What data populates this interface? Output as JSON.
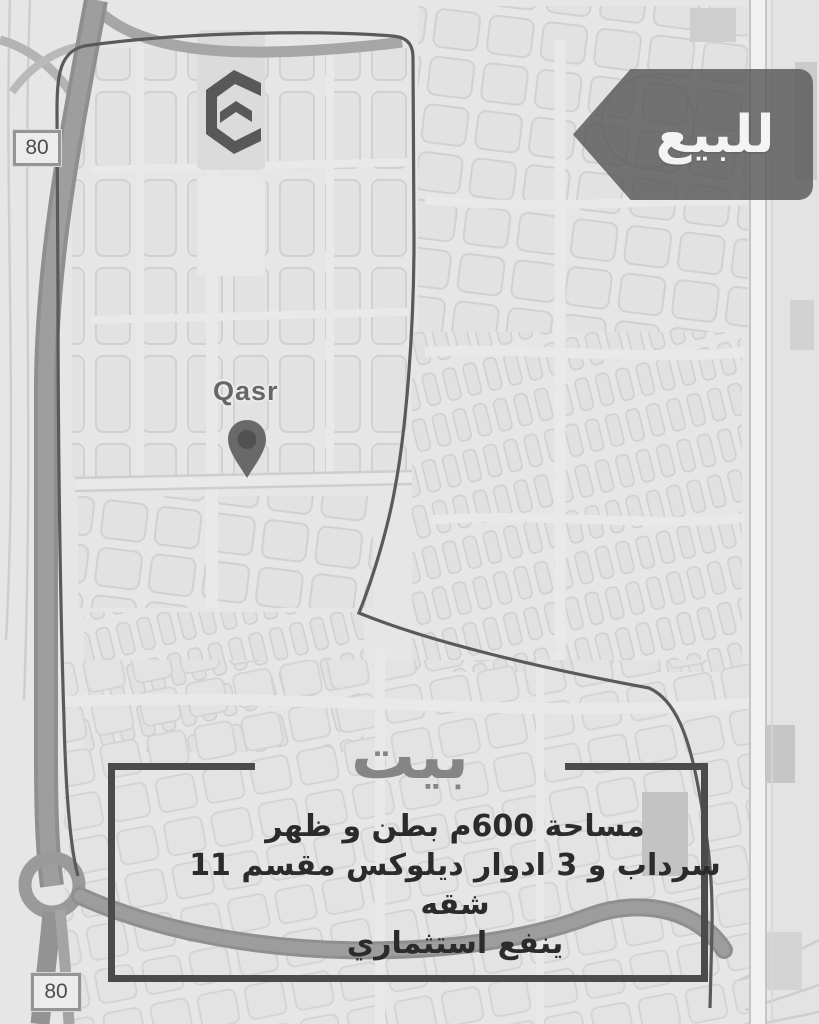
{
  "banner": {
    "label": "للبيع"
  },
  "logo": {
    "name": "chevron-e-logo"
  },
  "map": {
    "place_label": "Qasr",
    "road_badges": {
      "top": "80",
      "bottom": "80"
    }
  },
  "listing": {
    "headline": "بيت",
    "details": [
      "مساحة 600م بطن و ظهر",
      "سرداب و 3 ادوار ديلوكس مقسم 11 شقه",
      "ينفع استثماري"
    ]
  },
  "colors": {
    "map_bg": "#e6e6e6",
    "banner_bg": "#585858",
    "banner_text": "#f4f4f4",
    "boundary_line": "#5a5a5a",
    "box_border": "#4b4b4b",
    "headline_text": "#858585",
    "details_text": "#2b2b2b",
    "highway": "#979797"
  }
}
